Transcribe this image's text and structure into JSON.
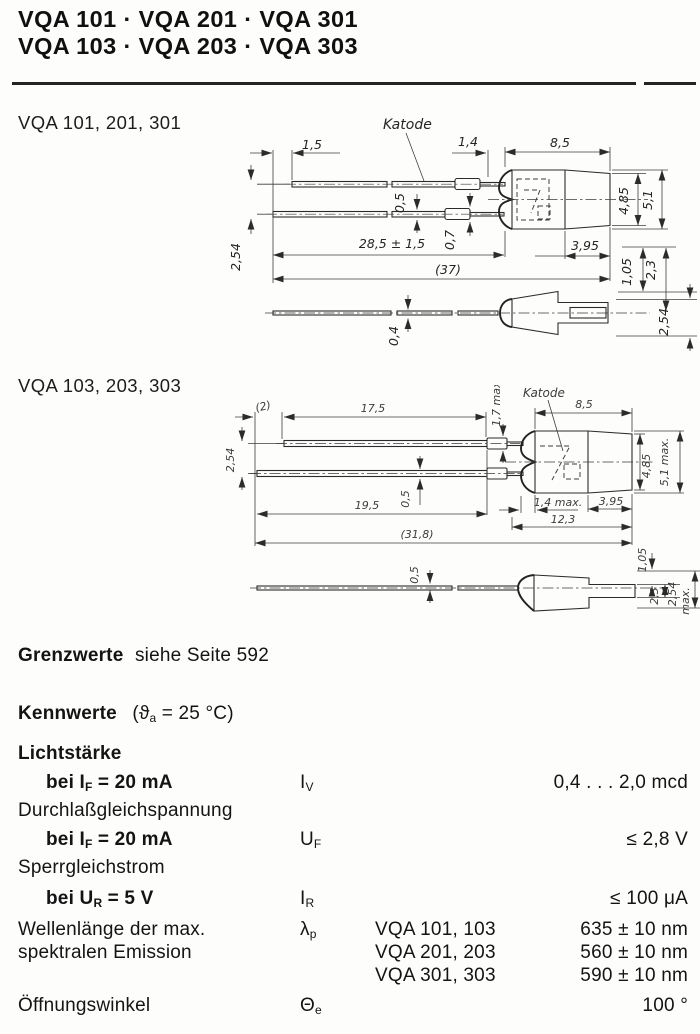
{
  "header": {
    "line1": "VQA 101 · VQA 201 · VQA 301",
    "line2": "VQA 103 · VQA 203 · VQA 303"
  },
  "drawing1": {
    "label": "VQA 101, 201, 301",
    "dims": {
      "lead_offset": "1,5",
      "katode": "Katode",
      "tab_to_body": "1,4",
      "body_length": "8,5",
      "lead_thickness": "0,5",
      "tab_thickness": "0,7",
      "lead_length": "28,5 ± 1,5",
      "overall_length": "(37)",
      "rear_length": "3,95",
      "body_height": "4,85",
      "overall_height": "5,1",
      "lead_pitch": "2,54",
      "offset_top": "1,05",
      "offset_mid": "2,3",
      "side_lead_thickness": "0,4",
      "side_offset": "2,54"
    }
  },
  "drawing2": {
    "label": "VQA 103, 203, 303",
    "dims": {
      "tip_offset": "(2)",
      "top_lead_length": "17,5",
      "tab_height": "1,7 max",
      "katode": "Katode",
      "body_length": "8,5",
      "lead_pitch": "2,54",
      "lead_thickness": "0,5",
      "bottom_lead_length": "19,5",
      "dome_depth": "1,4 max.",
      "rear_length": "3,95",
      "body_total": "12,3",
      "overall_length": "(31,8)",
      "body_height": "4,85",
      "overall_height": "5,1 max.",
      "side_lead_thickness": "0,5",
      "offset_top": "1,05",
      "offset_mid": "2,3",
      "side_offset": "2,54",
      "side_offset_suffix": "max."
    }
  },
  "grenzwerte": {
    "bold": "Grenzwerte",
    "rest": "siehe Seite 592"
  },
  "kennwerte": {
    "heading": "Kennwerte",
    "cond": {
      "pre": "(ϑ",
      "sub": "a",
      "rest": " = 25 °C)"
    },
    "lichtstaerke": {
      "group": "Lichtstärke",
      "cond_pre": "bei I",
      "cond_sub": "F",
      "cond_rest": " = 20 mA",
      "sym_base": "I",
      "sym_sub": "V",
      "value": "0,4 . . . 2,0 mcd"
    },
    "durchlass": {
      "group": "Durchlaßgleichspannung",
      "cond_pre": "bei I",
      "cond_sub": "F",
      "cond_rest": " = 20 mA",
      "sym_base": "U",
      "sym_sub": "F",
      "value": "≤ 2,8 V"
    },
    "sperr": {
      "group": "Sperrgleichstrom",
      "cond_pre": "bei U",
      "cond_sub": "R",
      "cond_rest": " = 5 V",
      "sym_base": "I",
      "sym_sub": "R",
      "value": "≤ 100 μA"
    },
    "wellenlaenge": {
      "label1": "Wellenlänge der max.",
      "label2": "spektralen Emission",
      "sym_base": "λ",
      "sym_sub": "p",
      "variants": [
        {
          "types": "VQA 101, 103",
          "value": "635 ± 10 nm"
        },
        {
          "types": "VQA 201, 203",
          "value": "560 ± 10 nm"
        },
        {
          "types": "VQA 301, 303",
          "value": "590 ± 10 nm"
        }
      ]
    },
    "oeffnungswinkel": {
      "label": "Öffnungswinkel",
      "sym_base": "Θ",
      "sym_sub": "e",
      "value": "100 °"
    }
  }
}
